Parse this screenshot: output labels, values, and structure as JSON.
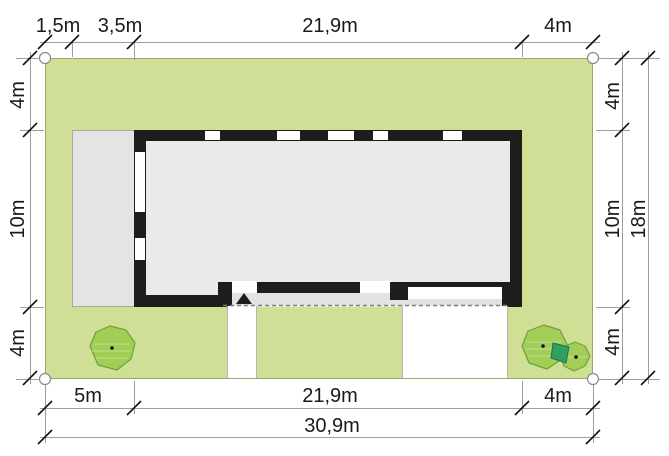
{
  "plan": {
    "type": "house-site-plan",
    "unit": "m",
    "colors": {
      "lawn": "#cfe096",
      "wall": "#1d1d1b",
      "house_interior": "#eaeaea",
      "terrace": "#e4e4e4",
      "porch": "#e2e2e2",
      "paving": "#ffffff",
      "tree_canopy": "#9ccb50",
      "tree_accent": "#2fa05f",
      "dimension_line": "#9e9e9e",
      "text": "#1a1a1a"
    },
    "dimensions": {
      "top": [
        "1,5m",
        "3,5m",
        "21,9m",
        "4m"
      ],
      "bottom": [
        "5m",
        "21,9m",
        "4m"
      ],
      "bottom_total": "30,9m",
      "left": [
        "4m",
        "10m",
        "4m"
      ],
      "right": [
        "4m",
        "10m",
        "4m"
      ],
      "right_total": "18m"
    },
    "symbols": {
      "entrance_marker": "black-triangle-up",
      "plot_corner_marker": "white-circle",
      "tree": "green-canopy-blob",
      "tree_count": 3
    }
  }
}
